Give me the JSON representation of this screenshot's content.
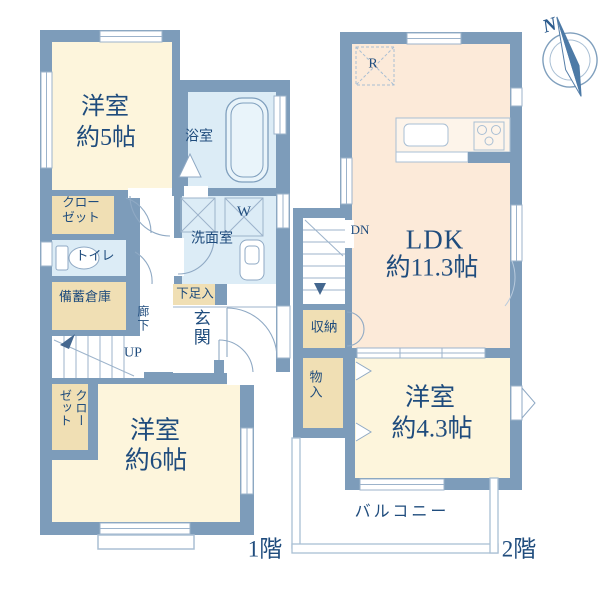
{
  "colors": {
    "wall": "#7d9cba",
    "room_cream": "#fdf5dc",
    "closet_tan": "#f0dfb4",
    "wet_blue": "#dcecf6",
    "ldk_peach": "#fcead9",
    "text_navy": "#1f4c7d",
    "thin_line": "#9cb3cb"
  },
  "floor1": {
    "label": "1階",
    "room5": {
      "line1": "洋室",
      "line2": "約5帖"
    },
    "bath": "浴室",
    "closet_top": {
      "line1": "クロー",
      "line2": "ゼット"
    },
    "toilet": "トイレ",
    "stock_storage": "備蓄倉庫",
    "washroom": "洗面室",
    "washer": "W",
    "shoe_box": "下足入",
    "hallway": "廊下",
    "up": "UP",
    "entrance": "玄関",
    "closet_bottom": {
      "col1": "クロー",
      "col2": "ゼット"
    },
    "room6": {
      "line1": "洋室",
      "line2": "約6帖"
    }
  },
  "floor2": {
    "label": "2階",
    "refrigerator": "R",
    "down": "DN",
    "ldk": {
      "line1": "LDK",
      "line2": "約11.3帖"
    },
    "storage": "収納",
    "closet": "物入",
    "room43": {
      "line1": "洋室",
      "line2": "約4.3帖"
    },
    "balcony": "バルコニー"
  },
  "compass": {
    "north": "N"
  }
}
